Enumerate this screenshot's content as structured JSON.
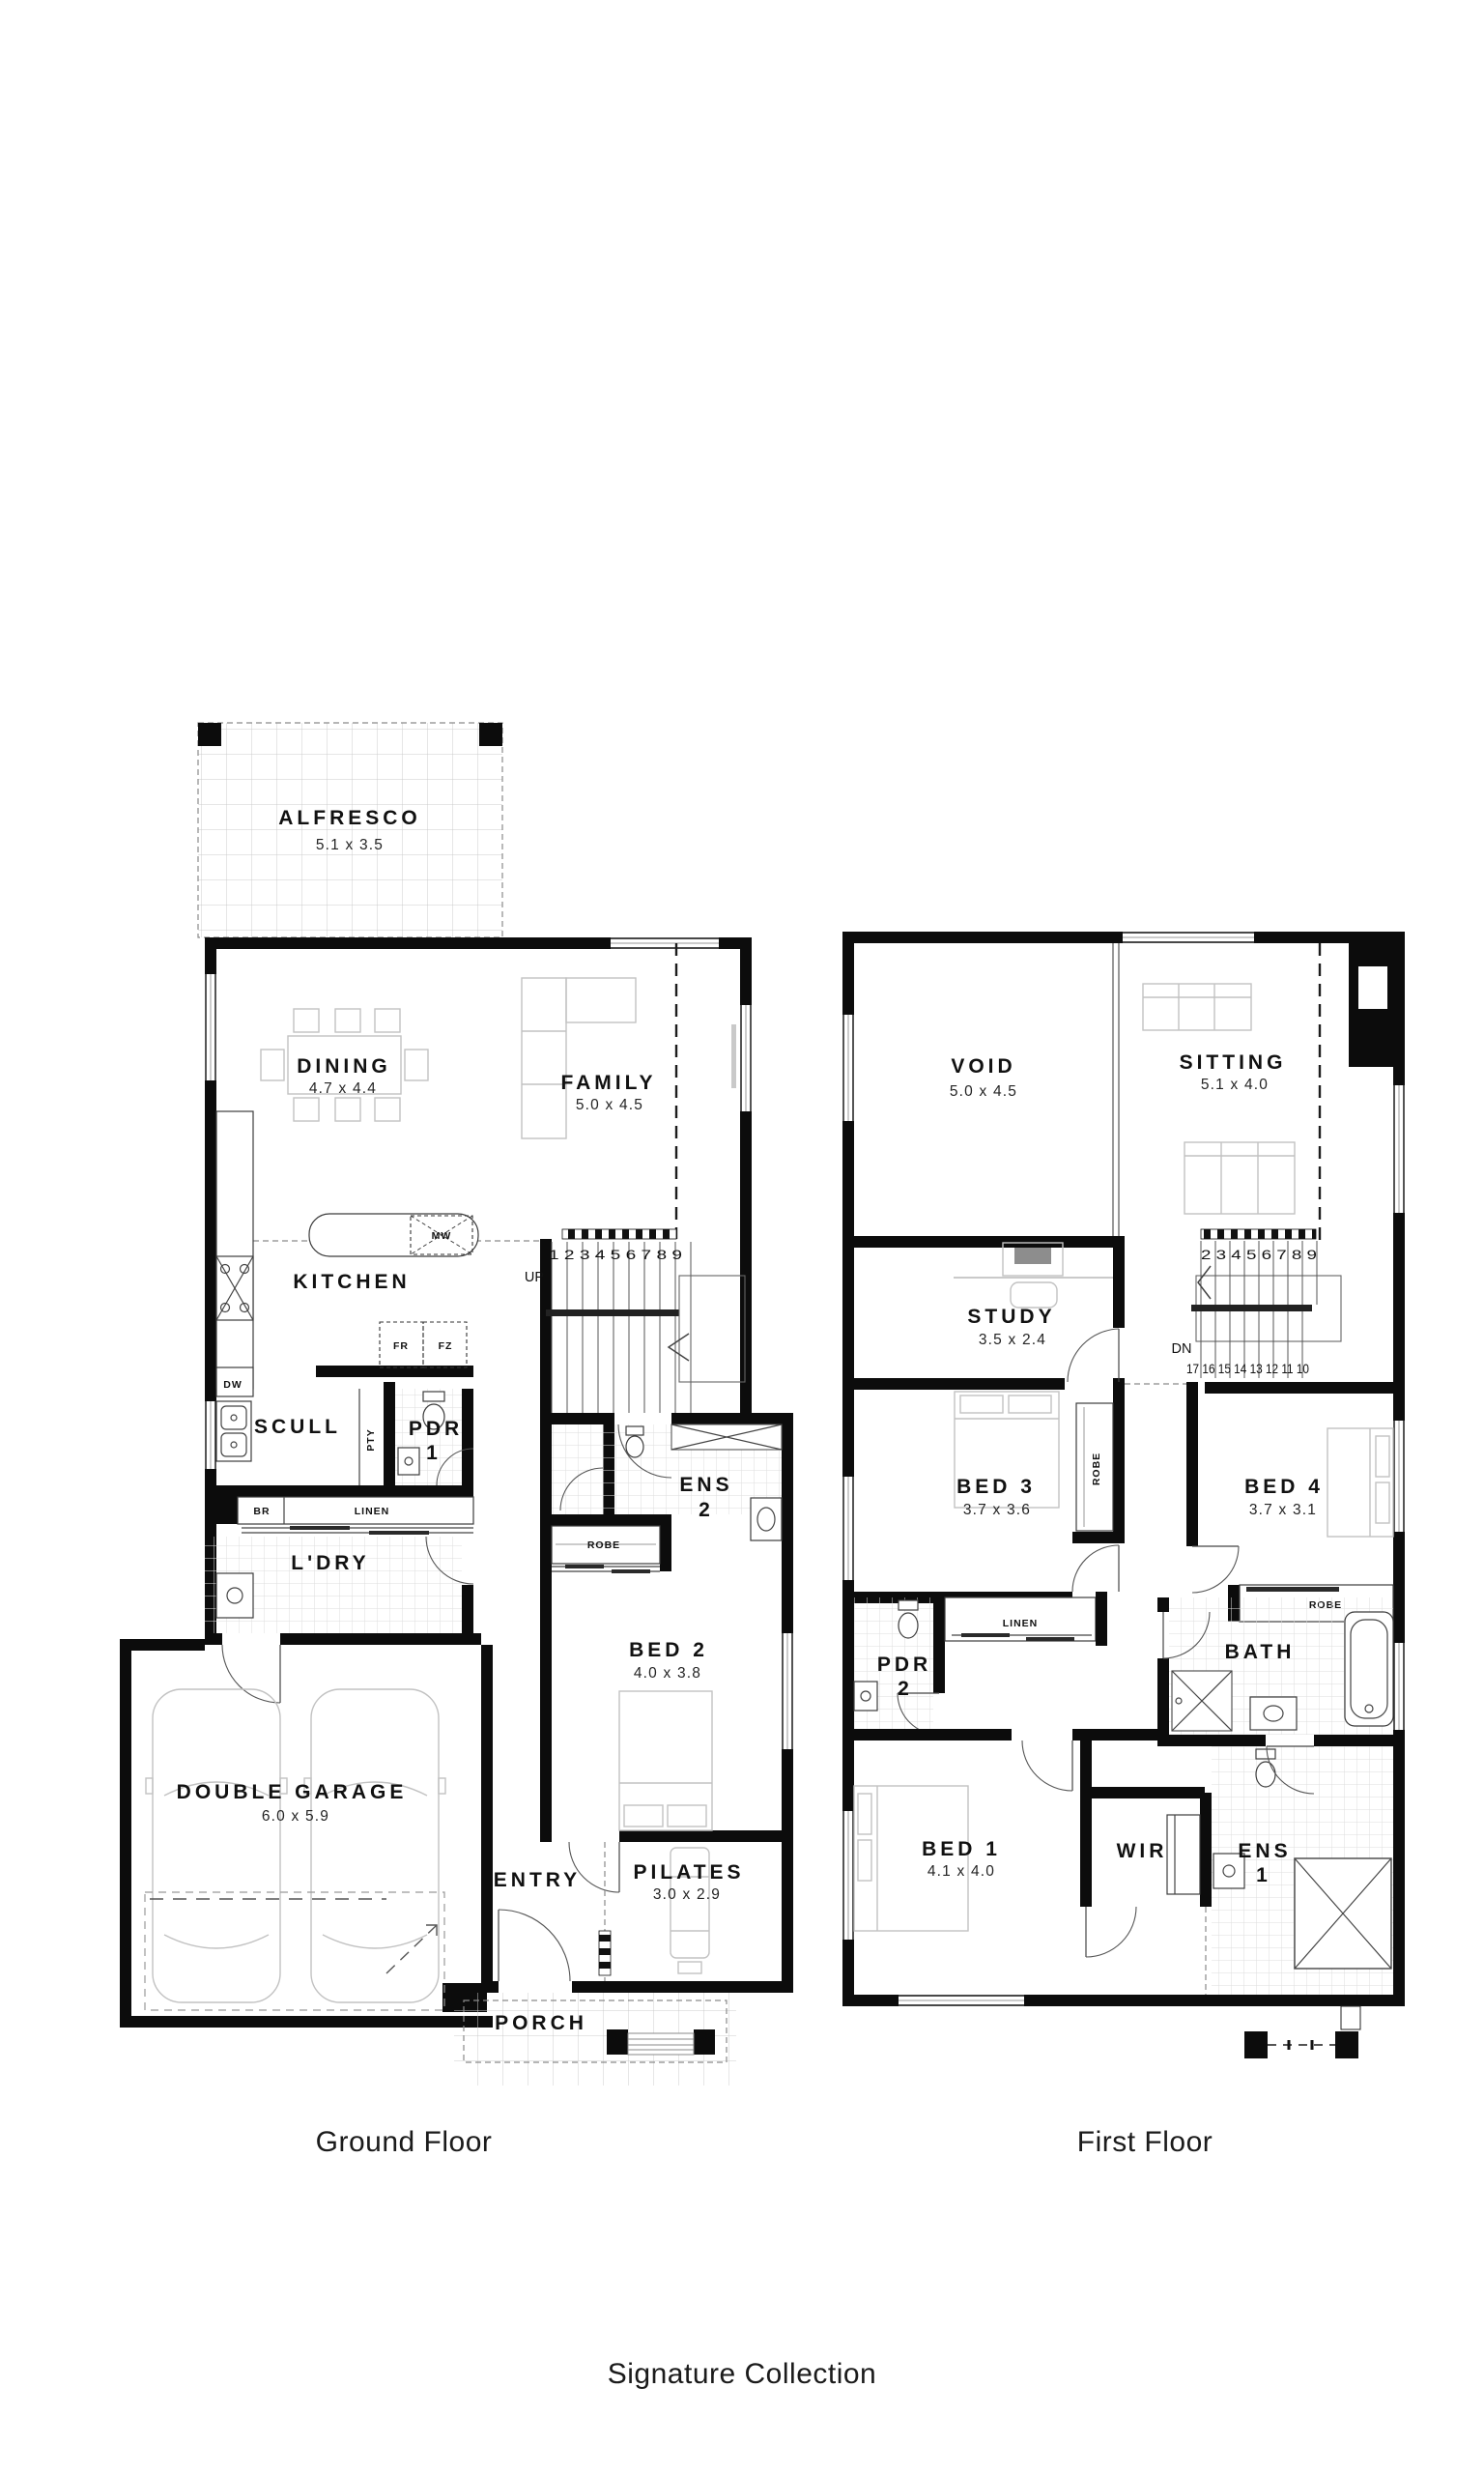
{
  "captions": {
    "gf": "Ground Floor",
    "ff": "First Floor",
    "collection": "Signature Collection"
  },
  "gf": {
    "rooms": {
      "alfresco": {
        "n": "ALFRESCO",
        "d": "5.1 x 3.5"
      },
      "dining": {
        "n": "DINING",
        "d": "4.7 x 4.4"
      },
      "family": {
        "n": "FAMILY",
        "d": "5.0 x 4.5"
      },
      "kitchen": {
        "n": "KITCHEN"
      },
      "scull": {
        "n": "SCULL"
      },
      "pdr1": {
        "l1": "PDR",
        "l2": "1"
      },
      "ens2": {
        "l1": "ENS",
        "l2": "2"
      },
      "ldry": {
        "n": "L'DRY"
      },
      "bed2": {
        "n": "BED 2",
        "d": "4.0 x 3.8"
      },
      "garage": {
        "n": "DOUBLE GARAGE",
        "d": "6.0 x 5.9"
      },
      "entry": {
        "n": "ENTRY"
      },
      "pilates": {
        "n": "PILATES",
        "d": "3.0 x 2.9"
      },
      "porch": {
        "n": "PORCH"
      }
    },
    "fix": {
      "mw": "MW",
      "fr": "FR",
      "fz": "FZ",
      "dw": "DW",
      "br": "BR",
      "linen": "LINEN",
      "robe": "ROBE",
      "pty": "PTY"
    },
    "stairs": {
      "dir": "UP",
      "run": "1 2 3 4 5 6 7 8 9"
    }
  },
  "ff": {
    "rooms": {
      "void": {
        "n": "VOID",
        "d": "5.0 x 4.5"
      },
      "sitting": {
        "n": "SITTING",
        "d": "5.1 x 4.0"
      },
      "study": {
        "n": "STUDY",
        "d": "3.5 x 2.4"
      },
      "bed3": {
        "n": "BED 3",
        "d": "3.7 x 3.6"
      },
      "bed4": {
        "n": "BED 4",
        "d": "3.7 x 3.1"
      },
      "pdr2": {
        "l1": "PDR",
        "l2": "2"
      },
      "bath": {
        "n": "BATH"
      },
      "bed1": {
        "n": "BED 1",
        "d": "4.1 x 4.0"
      },
      "wir": {
        "n": "WIR"
      },
      "ens1": {
        "l1": "ENS",
        "l2": "1"
      }
    },
    "fix": {
      "robe3": "ROBE",
      "robe4": "ROBE",
      "linen": "LINEN"
    },
    "stairs": {
      "dir": "DN",
      "up_run": "2 3 4 5 6 7 8 9",
      "down_run": "17 16 15 14 13 12 11 10"
    }
  }
}
